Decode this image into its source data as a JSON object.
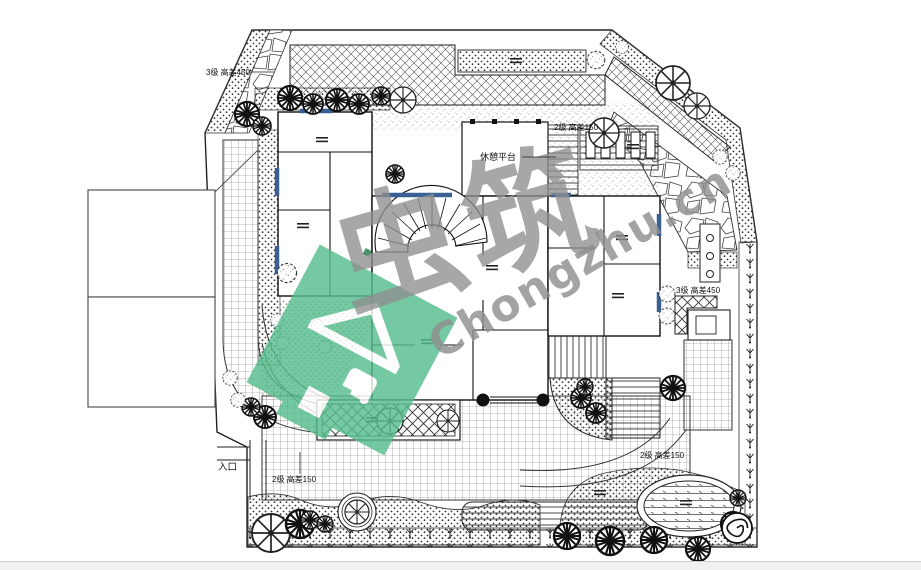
{
  "watermark": {
    "brand_cn": "虫筑",
    "brand_en": "Chongzhu.cn",
    "green": "#57BE8E",
    "gray": "#8F8F8F"
  },
  "plan": {
    "labels": {
      "entrance": "入口",
      "rest_platform": "休憩平台",
      "steps_top_left": "3级 高差450",
      "steps_deck": "2级 高差150",
      "steps_right": "3级 高差450",
      "steps_bottom_left": "2级 高差150",
      "steps_bottom_right": "2级 高差150"
    },
    "colors": {
      "line": "#1a1a1a",
      "window_blue": "#3A5F92",
      "paper": "#ffffff"
    }
  }
}
